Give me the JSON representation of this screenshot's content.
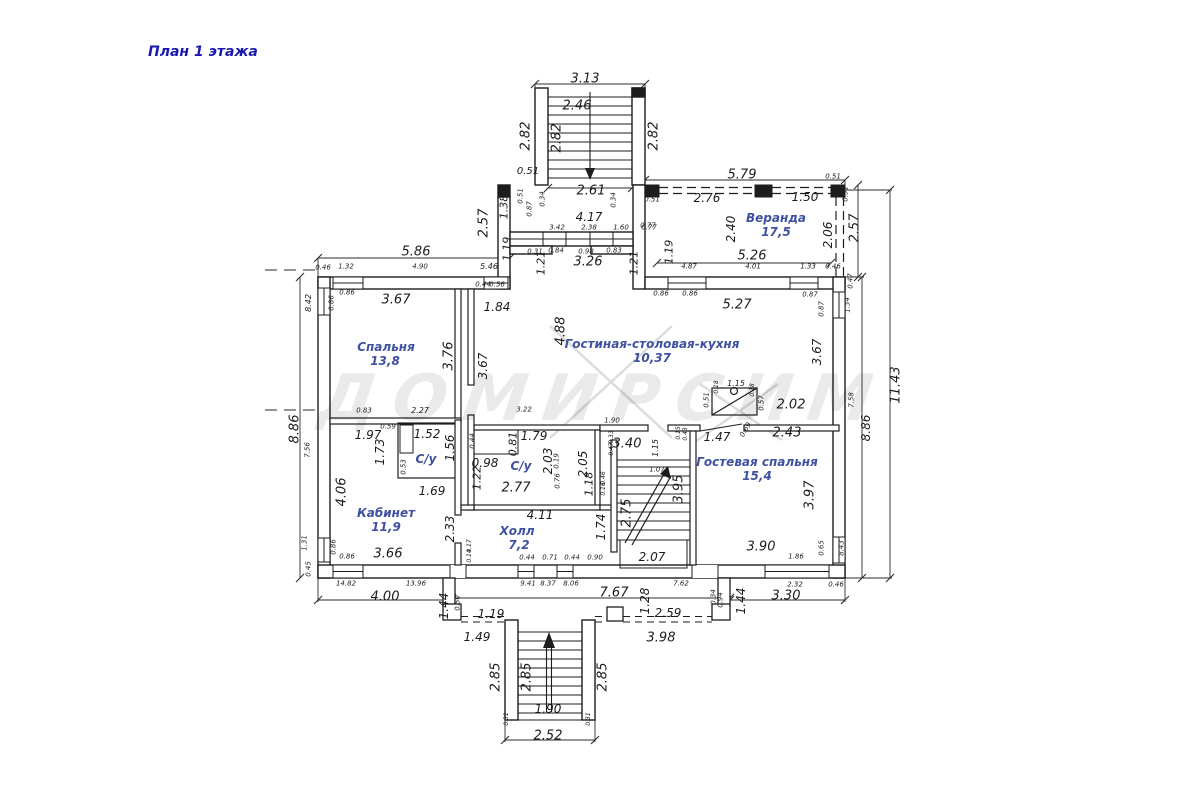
{
  "title": "План 1 этажа",
  "watermark": "ДОМИРСИМ",
  "plan": {
    "rooms": [
      {
        "name": "Спальня",
        "area": "13,8",
        "x": 386,
        "y": 347,
        "ax": 385,
        "ay": 361
      },
      {
        "name": "Кабинет",
        "area": "11,9",
        "x": 386,
        "y": 513,
        "ax": 386,
        "ay": 527
      },
      {
        "name": "С/у",
        "area": null,
        "x": 426,
        "y": 459
      },
      {
        "name": "С/у",
        "area": null,
        "x": 521,
        "y": 466
      },
      {
        "name": "Холл",
        "area": "7,2",
        "x": 517,
        "y": 531,
        "ax": 519,
        "ay": 545
      },
      {
        "name": "Гостиная-столовая-кухня",
        "area": "10,37",
        "x": 652,
        "y": 344,
        "ax": 652,
        "ay": 358
      },
      {
        "name": "Веранда",
        "area": "17,5",
        "x": 776,
        "y": 218,
        "ax": 776,
        "ay": 232
      },
      {
        "name": "Гостевая спальня",
        "area": "15,4",
        "x": 757,
        "y": 462,
        "ax": 757,
        "ay": 476
      }
    ],
    "labels": [
      {
        "t": "3.13",
        "x": 585,
        "y": 79,
        "s": 13
      },
      {
        "t": "2.46",
        "x": 577,
        "y": 106,
        "s": 13
      },
      {
        "t": "2.82",
        "x": 526,
        "y": 136,
        "r": -90,
        "s": 13
      },
      {
        "t": "2.82",
        "x": 557,
        "y": 138,
        "r": -90,
        "s": 13
      },
      {
        "t": "2.82",
        "x": 654,
        "y": 136,
        "r": -90,
        "s": 13
      },
      {
        "t": "0.51",
        "x": 528,
        "y": 172,
        "s": 10
      },
      {
        "t": "2.61",
        "x": 591,
        "y": 191,
        "s": 13
      },
      {
        "t": "0.51",
        "x": 521,
        "y": 196,
        "r": -90,
        "s": 7
      },
      {
        "t": "1.38",
        "x": 504,
        "y": 207,
        "r": -90,
        "s": 11
      },
      {
        "t": "0.87",
        "x": 530,
        "y": 209,
        "r": -90,
        "s": 7
      },
      {
        "t": "0.34",
        "x": 543,
        "y": 199,
        "r": -90,
        "s": 7
      },
      {
        "t": "0.34",
        "x": 614,
        "y": 200,
        "r": -90,
        "s": 7
      },
      {
        "t": "0.51",
        "x": 652,
        "y": 200,
        "s": 7
      },
      {
        "t": "2.57",
        "x": 484,
        "y": 223,
        "r": -90,
        "s": 13
      },
      {
        "t": "4.17",
        "x": 589,
        "y": 217,
        "s": 12
      },
      {
        "t": "3.42",
        "x": 557,
        "y": 228,
        "s": 7
      },
      {
        "t": "2.38",
        "x": 589,
        "y": 228,
        "s": 7
      },
      {
        "t": "1.60",
        "x": 621,
        "y": 228,
        "s": 7
      },
      {
        "t": "0.77",
        "x": 649,
        "y": 228,
        "s": 7
      },
      {
        "t": "1.19",
        "x": 507,
        "y": 249,
        "r": -90,
        "s": 11
      },
      {
        "t": "0.31",
        "x": 535,
        "y": 252,
        "s": 7
      },
      {
        "t": "0.84",
        "x": 556,
        "y": 251,
        "s": 7
      },
      {
        "t": "0.98",
        "x": 586,
        "y": 252,
        "s": 7
      },
      {
        "t": "0.83",
        "x": 614,
        "y": 251,
        "s": 7
      },
      {
        "t": "1.21",
        "x": 541,
        "y": 263,
        "r": -90,
        "s": 11
      },
      {
        "t": "3.26",
        "x": 588,
        "y": 262,
        "s": 13
      },
      {
        "t": "1.21",
        "x": 634,
        "y": 263,
        "r": -90,
        "s": 11
      },
      {
        "t": "5.46",
        "x": 489,
        "y": 267,
        "s": 8
      },
      {
        "t": "5.86",
        "x": 416,
        "y": 252,
        "s": 13
      },
      {
        "t": "0.46",
        "x": 323,
        "y": 268,
        "s": 7
      },
      {
        "t": "1.32",
        "x": 346,
        "y": 267,
        "s": 7
      },
      {
        "t": "4.90",
        "x": 420,
        "y": 267,
        "s": 7
      },
      {
        "t": "0.44",
        "x": 483,
        "y": 285,
        "s": 7
      },
      {
        "t": "0.56",
        "x": 497,
        "y": 285,
        "s": 7
      },
      {
        "t": "8.42",
        "x": 309,
        "y": 303,
        "r": -90,
        "s": 8
      },
      {
        "t": "0.86",
        "x": 332,
        "y": 303,
        "r": -90,
        "s": 7
      },
      {
        "t": "0.86",
        "x": 347,
        "y": 293,
        "s": 7
      },
      {
        "t": "3.67",
        "x": 396,
        "y": 300,
        "s": 13
      },
      {
        "t": "1.84",
        "x": 497,
        "y": 307,
        "s": 12
      },
      {
        "t": "3.76",
        "x": 449,
        "y": 356,
        "r": -90,
        "s": 13
      },
      {
        "t": "3.67",
        "x": 483,
        "y": 366,
        "r": -90,
        "s": 12
      },
      {
        "t": "8.86",
        "x": 295,
        "y": 429,
        "r": -90,
        "s": 13
      },
      {
        "t": "7.56",
        "x": 308,
        "y": 450,
        "r": -90,
        "s": 7
      },
      {
        "t": "2.27",
        "x": 420,
        "y": 411,
        "s": 8
      },
      {
        "t": "0.83",
        "x": 364,
        "y": 411,
        "s": 7
      },
      {
        "t": "0.86",
        "x": 661,
        "y": 294,
        "s": 7
      },
      {
        "t": "0.86",
        "x": 690,
        "y": 294,
        "s": 7
      },
      {
        "t": "5.27",
        "x": 737,
        "y": 305,
        "s": 13
      },
      {
        "t": "0.87",
        "x": 810,
        "y": 295,
        "s": 7
      },
      {
        "t": "0.87",
        "x": 822,
        "y": 309,
        "r": -90,
        "s": 7
      },
      {
        "t": "4.88",
        "x": 561,
        "y": 331,
        "r": -90,
        "s": 13
      },
      {
        "t": "3.67",
        "x": 817,
        "y": 352,
        "r": -90,
        "s": 12
      },
      {
        "t": "1.90",
        "x": 612,
        "y": 421,
        "s": 7
      },
      {
        "t": "3.22",
        "x": 524,
        "y": 410,
        "s": 7
      },
      {
        "t": "5.79",
        "x": 742,
        "y": 175,
        "s": 13
      },
      {
        "t": "2.76",
        "x": 707,
        "y": 198,
        "s": 12
      },
      {
        "t": "1.50",
        "x": 805,
        "y": 197,
        "s": 12
      },
      {
        "t": "0.51",
        "x": 833,
        "y": 177,
        "s": 7
      },
      {
        "t": "0.51",
        "x": 846,
        "y": 194,
        "r": -90,
        "s": 7
      },
      {
        "t": "0.77",
        "x": 648,
        "y": 226,
        "s": 7
      },
      {
        "t": "2.40",
        "x": 731,
        "y": 229,
        "r": -90,
        "s": 12
      },
      {
        "t": "5.26",
        "x": 752,
        "y": 256,
        "s": 13
      },
      {
        "t": "2.06",
        "x": 828,
        "y": 235,
        "r": -90,
        "s": 12
      },
      {
        "t": "2.57",
        "x": 855,
        "y": 228,
        "r": -90,
        "s": 13
      },
      {
        "t": "1.19",
        "x": 669,
        "y": 252,
        "r": -90,
        "s": 11
      },
      {
        "t": "4.87",
        "x": 689,
        "y": 267,
        "s": 7
      },
      {
        "t": "4.01",
        "x": 753,
        "y": 267,
        "s": 7
      },
      {
        "t": "1.33",
        "x": 808,
        "y": 267,
        "s": 7
      },
      {
        "t": "0.46",
        "x": 833,
        "y": 267,
        "s": 7
      },
      {
        "t": "0.47",
        "x": 851,
        "y": 281,
        "r": -90,
        "s": 7
      },
      {
        "t": "1.34",
        "x": 848,
        "y": 305,
        "r": -90,
        "s": 7
      },
      {
        "t": "11.43",
        "x": 896,
        "y": 385,
        "r": -90,
        "s": 13
      },
      {
        "t": "8.86",
        "x": 866,
        "y": 428,
        "r": -90,
        "s": 12
      },
      {
        "t": "7.58",
        "x": 852,
        "y": 400,
        "r": -90,
        "s": 7
      },
      {
        "t": "1.97",
        "x": 368,
        "y": 435,
        "s": 12
      },
      {
        "t": "1.52",
        "x": 427,
        "y": 434,
        "s": 12
      },
      {
        "t": "1.56",
        "x": 450,
        "y": 448,
        "r": -90,
        "s": 12
      },
      {
        "t": "1.73",
        "x": 380,
        "y": 452,
        "r": -90,
        "s": 12
      },
      {
        "t": "0.59",
        "x": 388,
        "y": 427,
        "s": 7
      },
      {
        "t": "0.53",
        "x": 404,
        "y": 467,
        "r": -90,
        "s": 7
      },
      {
        "t": "1.69",
        "x": 432,
        "y": 491,
        "s": 12
      },
      {
        "t": "0.98",
        "x": 485,
        "y": 463,
        "s": 12
      },
      {
        "t": "1.22",
        "x": 477,
        "y": 478,
        "r": -90,
        "s": 11
      },
      {
        "t": "1.79",
        "x": 534,
        "y": 436,
        "s": 12
      },
      {
        "t": "0.81",
        "x": 513,
        "y": 444,
        "r": -90,
        "s": 11
      },
      {
        "t": "2.03",
        "x": 548,
        "y": 461,
        "r": -90,
        "s": 12
      },
      {
        "t": "2.05",
        "x": 583,
        "y": 464,
        "r": -90,
        "s": 12
      },
      {
        "t": "0.44",
        "x": 473,
        "y": 441,
        "r": -90,
        "s": 7
      },
      {
        "t": "0.19",
        "x": 557,
        "y": 461,
        "r": -90,
        "s": 7
      },
      {
        "t": "0.76",
        "x": 558,
        "y": 481,
        "r": -90,
        "s": 7
      },
      {
        "t": "2.77",
        "x": 516,
        "y": 488,
        "s": 13
      },
      {
        "t": "4.06",
        "x": 342,
        "y": 492,
        "r": -90,
        "s": 13
      },
      {
        "t": "2.33",
        "x": 450,
        "y": 529,
        "r": -90,
        "s": 12
      },
      {
        "t": "3.66",
        "x": 388,
        "y": 554,
        "s": 13
      },
      {
        "t": "1.31",
        "x": 305,
        "y": 543,
        "r": -90,
        "s": 7
      },
      {
        "t": "0.86",
        "x": 334,
        "y": 547,
        "r": -90,
        "s": 7
      },
      {
        "t": "0.86",
        "x": 347,
        "y": 557,
        "s": 7
      },
      {
        "t": "0.45",
        "x": 309,
        "y": 569,
        "r": -90,
        "s": 7
      },
      {
        "t": "4.11",
        "x": 540,
        "y": 515,
        "s": 12
      },
      {
        "t": "1.74",
        "x": 601,
        "y": 527,
        "r": -90,
        "s": 12
      },
      {
        "t": "3.40",
        "x": 627,
        "y": 444,
        "s": 13
      },
      {
        "t": "1.15",
        "x": 656,
        "y": 448,
        "r": -90,
        "s": 8
      },
      {
        "t": "1.07",
        "x": 657,
        "y": 470,
        "s": 7
      },
      {
        "t": "2.75",
        "x": 627,
        "y": 513,
        "r": -90,
        "s": 13
      },
      {
        "t": "3.95",
        "x": 679,
        "y": 489,
        "r": -90,
        "s": 13
      },
      {
        "t": "2.07",
        "x": 652,
        "y": 557,
        "s": 12
      },
      {
        "t": "1.18",
        "x": 589,
        "y": 484,
        "r": -90,
        "s": 11
      },
      {
        "t": "0.33",
        "x": 612,
        "y": 437,
        "r": -90,
        "s": 6
      },
      {
        "t": "0.47",
        "x": 612,
        "y": 449,
        "r": -90,
        "s": 6
      },
      {
        "t": "0.46",
        "x": 604,
        "y": 478,
        "r": -90,
        "s": 6
      },
      {
        "t": "0.16",
        "x": 604,
        "y": 489,
        "r": -90,
        "s": 6
      },
      {
        "t": "1.47",
        "x": 717,
        "y": 437,
        "s": 12
      },
      {
        "t": "2.43",
        "x": 787,
        "y": 433,
        "s": 13
      },
      {
        "t": "3.97",
        "x": 810,
        "y": 495,
        "r": -90,
        "s": 13
      },
      {
        "t": "3.90",
        "x": 761,
        "y": 547,
        "s": 13
      },
      {
        "t": "1.86",
        "x": 796,
        "y": 557,
        "s": 7
      },
      {
        "t": "0.65",
        "x": 822,
        "y": 548,
        "r": -90,
        "s": 7
      },
      {
        "t": "8.43",
        "x": 842,
        "y": 548,
        "r": -90,
        "s": 7
      },
      {
        "t": "0.69",
        "x": 746,
        "y": 430,
        "r": -60,
        "s": 7
      },
      {
        "t": "0.15",
        "x": 679,
        "y": 433,
        "r": -90,
        "s": 6
      },
      {
        "t": "0.43",
        "x": 686,
        "y": 434,
        "r": -90,
        "s": 6
      },
      {
        "t": "1.15",
        "x": 736,
        "y": 384,
        "s": 8
      },
      {
        "t": "0.51",
        "x": 707,
        "y": 400,
        "r": -90,
        "s": 7
      },
      {
        "t": "0.57",
        "x": 762,
        "y": 403,
        "r": -90,
        "s": 7
      },
      {
        "t": "0.18",
        "x": 717,
        "y": 387,
        "r": -90,
        "s": 6
      },
      {
        "t": "0.18",
        "x": 753,
        "y": 390,
        "r": -90,
        "s": 6
      },
      {
        "t": "2.02",
        "x": 791,
        "y": 405,
        "s": 13
      },
      {
        "t": "14.82",
        "x": 346,
        "y": 584,
        "s": 7
      },
      {
        "t": "13.96",
        "x": 416,
        "y": 584,
        "s": 7
      },
      {
        "t": "4.00",
        "x": 385,
        "y": 597,
        "s": 13
      },
      {
        "t": "1.44",
        "x": 444,
        "y": 606,
        "r": -90,
        "s": 12
      },
      {
        "t": "0.50",
        "x": 458,
        "y": 603,
        "r": -90,
        "s": 7
      },
      {
        "t": "1.19",
        "x": 491,
        "y": 614,
        "s": 12
      },
      {
        "t": "1.49",
        "x": 477,
        "y": 637,
        "s": 12
      },
      {
        "t": "0.17",
        "x": 470,
        "y": 546,
        "r": -90,
        "s": 6
      },
      {
        "t": "0.14",
        "x": 470,
        "y": 556,
        "r": -90,
        "s": 6
      },
      {
        "t": "0.44",
        "x": 527,
        "y": 558,
        "s": 7
      },
      {
        "t": "0.71",
        "x": 550,
        "y": 558,
        "s": 7
      },
      {
        "t": "0.44",
        "x": 572,
        "y": 558,
        "s": 7
      },
      {
        "t": "0.90",
        "x": 595,
        "y": 558,
        "s": 7
      },
      {
        "t": "9.41",
        "x": 528,
        "y": 584,
        "s": 7
      },
      {
        "t": "8.37",
        "x": 548,
        "y": 584,
        "s": 7
      },
      {
        "t": "8.06",
        "x": 571,
        "y": 584,
        "s": 7
      },
      {
        "t": "7.67",
        "x": 614,
        "y": 593,
        "s": 13
      },
      {
        "t": "7.62",
        "x": 681,
        "y": 584,
        "s": 7
      },
      {
        "t": "1.28",
        "x": 645,
        "y": 601,
        "r": -90,
        "s": 12
      },
      {
        "t": "2.59",
        "x": 668,
        "y": 613,
        "s": 12
      },
      {
        "t": "3.98",
        "x": 661,
        "y": 638,
        "s": 13
      },
      {
        "t": "1.44",
        "x": 741,
        "y": 601,
        "r": -90,
        "s": 12
      },
      {
        "t": "0.34",
        "x": 714,
        "y": 597,
        "r": -90,
        "s": 7
      },
      {
        "t": "0.94",
        "x": 721,
        "y": 600,
        "r": -90,
        "s": 7
      },
      {
        "t": "2.32",
        "x": 795,
        "y": 585,
        "s": 7
      },
      {
        "t": "0.46",
        "x": 836,
        "y": 585,
        "s": 7
      },
      {
        "t": "3.30",
        "x": 786,
        "y": 596,
        "s": 13
      },
      {
        "t": "2.85",
        "x": 496,
        "y": 677,
        "r": -90,
        "s": 13
      },
      {
        "t": "2.85",
        "x": 527,
        "y": 677,
        "r": -90,
        "s": 13
      },
      {
        "t": "2.85",
        "x": 603,
        "y": 677,
        "r": -90,
        "s": 13
      },
      {
        "t": "1.90",
        "x": 548,
        "y": 709,
        "s": 12
      },
      {
        "t": "2.52",
        "x": 548,
        "y": 736,
        "s": 13
      },
      {
        "t": "0.31",
        "x": 507,
        "y": 719,
        "r": -90,
        "s": 6
      },
      {
        "t": "0.31",
        "x": 589,
        "y": 719,
        "r": -90,
        "s": 6
      }
    ]
  }
}
